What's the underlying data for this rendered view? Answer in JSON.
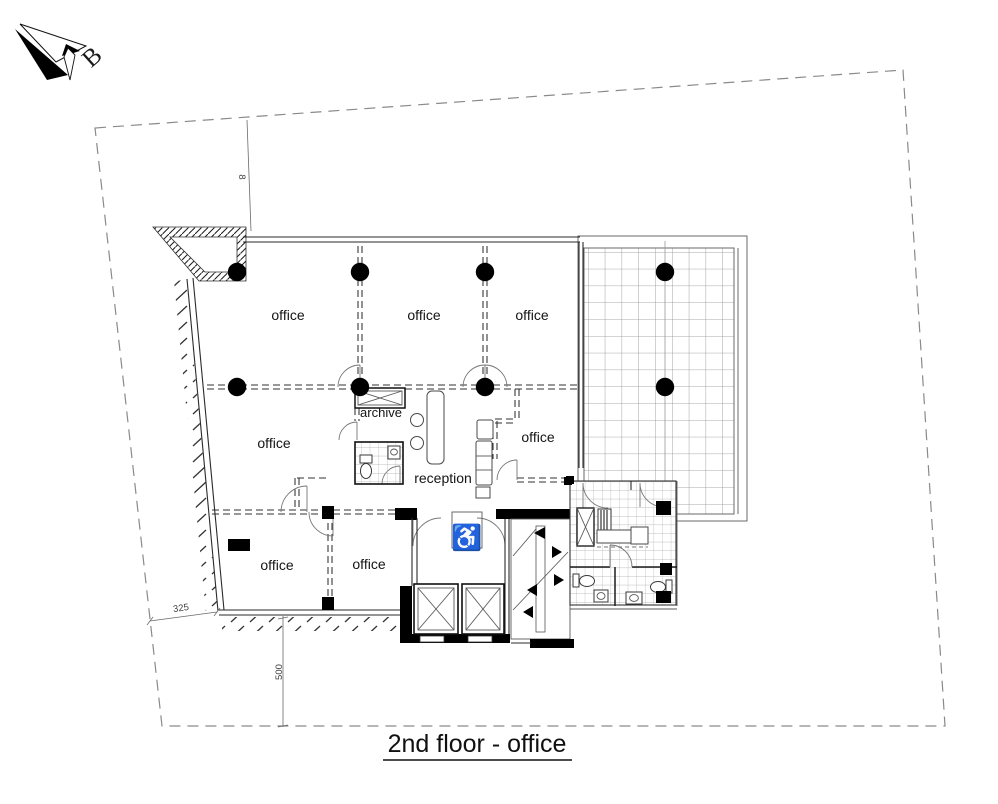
{
  "title": {
    "text": "2nd floor - office"
  },
  "north": {
    "label": "B"
  },
  "dimensions": {
    "top": "8",
    "diagonal": "325",
    "left": "500"
  },
  "rooms": {
    "office_top_left": "office",
    "office_top_middle": "office",
    "office_top_right": "office",
    "office_middle_left": "office",
    "archive": "archive",
    "reception": "reception",
    "office_middle_right": "office",
    "office_bottom_left": "office",
    "office_bottom_middle": "office"
  },
  "icons": {
    "wheelchair": "♿"
  },
  "colors": {
    "ink": "#1c1c1c",
    "wall_fill": "#000000",
    "partition_line": "#303030",
    "boundary_line": "#8a8a8a",
    "terrace_grid_line": "#8d8d8d",
    "tile_line": "#a8a8a8",
    "background": "#ffffff"
  }
}
